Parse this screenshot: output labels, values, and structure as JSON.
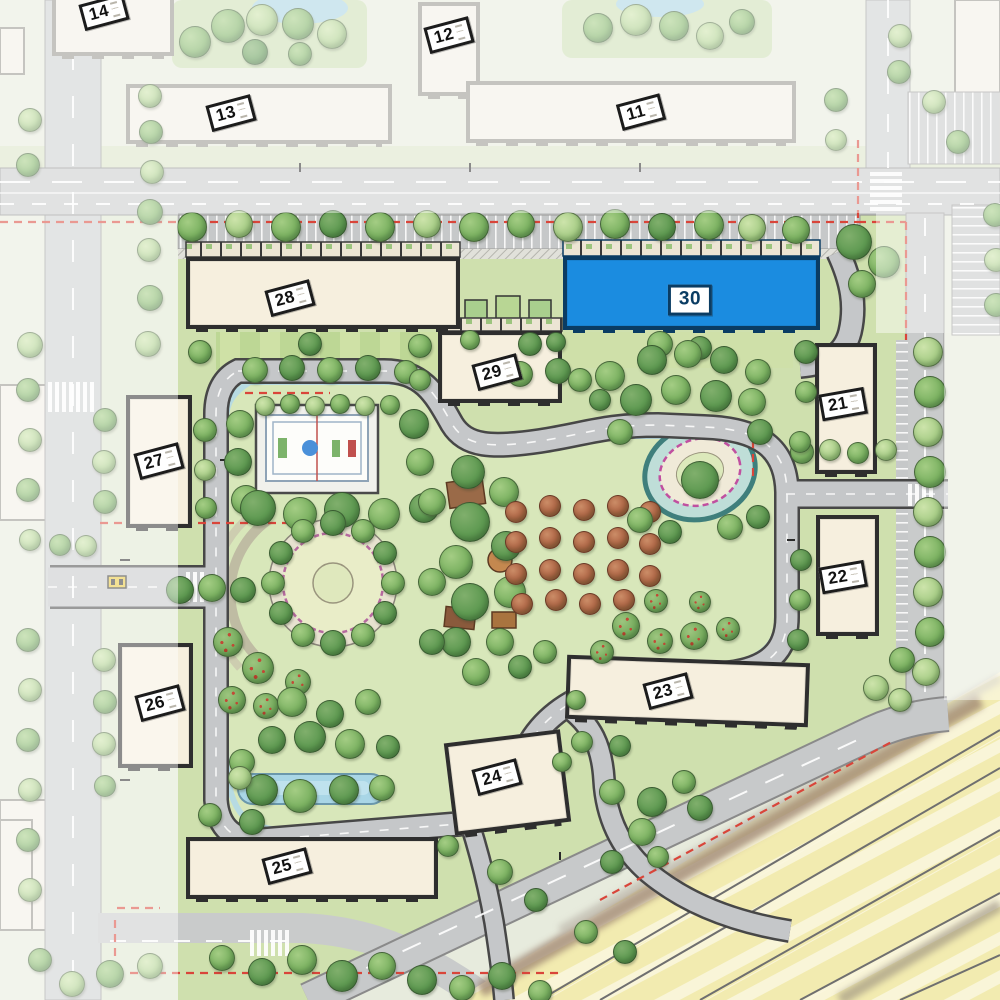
{
  "map": {
    "name": "Residential compound master plan — building selector",
    "colors": {
      "highlight": "#1b8ce0",
      "highlight_border": "#0a3c63",
      "boundary_dash": "#d9453a",
      "building_fill": "#f6efde",
      "park_green": "#d8e7ba",
      "road_gray": "#c7c9ca",
      "railway_yellow": "#f2ebb0"
    },
    "selected_building": "30",
    "buildings": [
      {
        "num": "14",
        "x": 52,
        "y": -6,
        "w": 122,
        "h": 62,
        "rot": 0,
        "lx": 104,
        "ly": 12,
        "lrot": -15,
        "state": "faded"
      },
      {
        "num": "13",
        "x": 126,
        "y": 84,
        "w": 266,
        "h": 60,
        "rot": 0,
        "lx": 231,
        "ly": 113,
        "lrot": -15,
        "state": "faded"
      },
      {
        "num": "12",
        "x": 418,
        "y": 2,
        "w": 62,
        "h": 94,
        "rot": 0,
        "lx": 449,
        "ly": 35,
        "lrot": -15,
        "state": "faded"
      },
      {
        "num": "11",
        "x": 466,
        "y": 81,
        "w": 330,
        "h": 62,
        "rot": 0,
        "lx": 641,
        "ly": 112,
        "lrot": -15,
        "state": "faded"
      },
      {
        "num": "28",
        "x": 186,
        "y": 257,
        "w": 274,
        "h": 72,
        "rot": 0,
        "lx": 290,
        "ly": 298,
        "lrot": -15,
        "state": "normal"
      },
      {
        "num": "30",
        "x": 563,
        "y": 256,
        "w": 257,
        "h": 74,
        "rot": 0,
        "lx": 690,
        "ly": 300,
        "lrot": 0,
        "state": "highlight"
      },
      {
        "num": "29",
        "x": 438,
        "y": 331,
        "w": 124,
        "h": 72,
        "rot": 0,
        "lx": 497,
        "ly": 372,
        "lrot": -15,
        "state": "normal"
      },
      {
        "num": "21",
        "x": 815,
        "y": 343,
        "w": 62,
        "h": 131,
        "rot": 0,
        "lx": 843,
        "ly": 404,
        "lrot": -10,
        "state": "normal"
      },
      {
        "num": "27",
        "x": 126,
        "y": 395,
        "w": 66,
        "h": 133,
        "rot": 0,
        "lx": 159,
        "ly": 461,
        "lrot": -15,
        "state": "normal"
      },
      {
        "num": "22",
        "x": 816,
        "y": 515,
        "w": 63,
        "h": 121,
        "rot": 0,
        "lx": 843,
        "ly": 577,
        "lrot": -10,
        "state": "normal"
      },
      {
        "num": "26",
        "x": 118,
        "y": 643,
        "w": 75,
        "h": 125,
        "rot": 0,
        "lx": 160,
        "ly": 703,
        "lrot": -15,
        "state": "normal"
      },
      {
        "num": "23",
        "x": 566,
        "y": 659,
        "w": 243,
        "h": 64,
        "rot": 2,
        "lx": 668,
        "ly": 691,
        "lrot": -15,
        "state": "normal"
      },
      {
        "num": "24",
        "x": 449,
        "y": 736,
        "w": 117,
        "h": 93,
        "rot": -7,
        "lx": 497,
        "ly": 777,
        "lrot": -15,
        "state": "normal"
      },
      {
        "num": "25",
        "x": 186,
        "y": 837,
        "w": 252,
        "h": 62,
        "rot": 0,
        "lx": 287,
        "ly": 866,
        "lrot": -15,
        "state": "normal"
      }
    ],
    "trees": [
      [
        195,
        42,
        16,
        "m"
      ],
      [
        228,
        26,
        17,
        "m"
      ],
      [
        262,
        20,
        16,
        "l"
      ],
      [
        298,
        24,
        16,
        "m"
      ],
      [
        332,
        34,
        15,
        "l"
      ],
      [
        255,
        52,
        13,
        "d"
      ],
      [
        300,
        54,
        12,
        "m"
      ],
      [
        598,
        28,
        15,
        "m"
      ],
      [
        636,
        20,
        16,
        "l"
      ],
      [
        674,
        26,
        15,
        "m"
      ],
      [
        710,
        36,
        14,
        "l"
      ],
      [
        742,
        22,
        13,
        "m"
      ],
      [
        150,
        96,
        12,
        "l"
      ],
      [
        151,
        132,
        12,
        "m"
      ],
      [
        152,
        172,
        12,
        "l"
      ],
      [
        150,
        212,
        13,
        "m"
      ],
      [
        149,
        250,
        12,
        "l"
      ],
      [
        150,
        298,
        13,
        "m"
      ],
      [
        148,
        344,
        13,
        "l"
      ],
      [
        30,
        120,
        12,
        "l"
      ],
      [
        28,
        165,
        12,
        "m"
      ],
      [
        30,
        345,
        13,
        "l"
      ],
      [
        28,
        390,
        12,
        "m"
      ],
      [
        30,
        440,
        12,
        "l"
      ],
      [
        28,
        490,
        12,
        "m"
      ],
      [
        30,
        540,
        11,
        "l"
      ],
      [
        60,
        545,
        11,
        "m"
      ],
      [
        86,
        546,
        11,
        "l"
      ],
      [
        28,
        640,
        12,
        "m"
      ],
      [
        30,
        690,
        12,
        "l"
      ],
      [
        28,
        740,
        12,
        "m"
      ],
      [
        30,
        790,
        12,
        "l"
      ],
      [
        28,
        840,
        12,
        "m"
      ],
      [
        30,
        890,
        12,
        "l"
      ],
      [
        105,
        420,
        12,
        "m"
      ],
      [
        104,
        462,
        12,
        "l"
      ],
      [
        105,
        502,
        12,
        "m"
      ],
      [
        104,
        660,
        12,
        "l"
      ],
      [
        105,
        702,
        12,
        "m"
      ],
      [
        104,
        744,
        12,
        "l"
      ],
      [
        105,
        786,
        11,
        "m"
      ],
      [
        40,
        960,
        12,
        "m"
      ],
      [
        72,
        984,
        13,
        "l"
      ],
      [
        110,
        974,
        14,
        "m"
      ],
      [
        150,
        966,
        13,
        "l"
      ],
      [
        900,
        36,
        12,
        "l"
      ],
      [
        899,
        72,
        12,
        "m"
      ],
      [
        934,
        102,
        12,
        "l"
      ],
      [
        958,
        142,
        12,
        "m"
      ],
      [
        836,
        100,
        12,
        "m"
      ],
      [
        836,
        140,
        11,
        "l"
      ],
      [
        995,
        215,
        12,
        "m"
      ],
      [
        996,
        260,
        12,
        "l"
      ],
      [
        996,
        305,
        12,
        "m"
      ],
      [
        192,
        227,
        15,
        "m"
      ],
      [
        239,
        224,
        14,
        "l"
      ],
      [
        286,
        227,
        15,
        "m"
      ],
      [
        333,
        224,
        14,
        "d"
      ],
      [
        380,
        227,
        15,
        "m"
      ],
      [
        427,
        224,
        14,
        "l"
      ],
      [
        474,
        227,
        15,
        "m"
      ],
      [
        521,
        224,
        14,
        "m"
      ],
      [
        568,
        227,
        15,
        "l"
      ],
      [
        615,
        224,
        15,
        "m"
      ],
      [
        662,
        227,
        14,
        "d"
      ],
      [
        709,
        225,
        15,
        "m"
      ],
      [
        752,
        228,
        14,
        "l"
      ],
      [
        796,
        230,
        14,
        "m"
      ],
      [
        854,
        242,
        18,
        "d"
      ],
      [
        884,
        262,
        16,
        "m"
      ],
      [
        862,
        284,
        14,
        "m"
      ],
      [
        928,
        352,
        15,
        "l"
      ],
      [
        930,
        392,
        16,
        "m"
      ],
      [
        928,
        432,
        15,
        "l"
      ],
      [
        930,
        472,
        16,
        "m"
      ],
      [
        928,
        512,
        15,
        "l"
      ],
      [
        930,
        552,
        16,
        "m"
      ],
      [
        928,
        592,
        15,
        "l"
      ],
      [
        930,
        632,
        15,
        "m"
      ],
      [
        926,
        672,
        14,
        "l"
      ],
      [
        902,
        660,
        13,
        "m"
      ],
      [
        876,
        688,
        13,
        "l"
      ],
      [
        900,
        700,
        12,
        "l"
      ],
      [
        802,
        452,
        12,
        "m"
      ],
      [
        830,
        450,
        11,
        "l"
      ],
      [
        858,
        453,
        11,
        "m"
      ],
      [
        886,
        450,
        11,
        "l"
      ],
      [
        806,
        352,
        12,
        "d"
      ],
      [
        806,
        392,
        11,
        "m"
      ],
      [
        200,
        352,
        12,
        "m"
      ],
      [
        310,
        344,
        12,
        "d"
      ],
      [
        420,
        346,
        12,
        "m"
      ],
      [
        530,
        344,
        12,
        "d"
      ],
      [
        660,
        344,
        13,
        "m"
      ],
      [
        700,
        348,
        12,
        "d"
      ],
      [
        205,
        430,
        12,
        "m"
      ],
      [
        205,
        470,
        11,
        "l"
      ],
      [
        206,
        508,
        11,
        "m"
      ],
      [
        180,
        590,
        14,
        "d"
      ],
      [
        212,
        588,
        14,
        "m"
      ],
      [
        243,
        590,
        13,
        "d"
      ],
      [
        255,
        370,
        13,
        "m"
      ],
      [
        292,
        368,
        13,
        "d"
      ],
      [
        330,
        370,
        13,
        "m"
      ],
      [
        368,
        368,
        13,
        "d"
      ],
      [
        406,
        372,
        12,
        "m"
      ],
      [
        520,
        374,
        13,
        "m"
      ],
      [
        558,
        371,
        13,
        "d"
      ],
      [
        610,
        376,
        15,
        "m"
      ],
      [
        652,
        360,
        15,
        "d"
      ],
      [
        688,
        354,
        14,
        "m"
      ],
      [
        724,
        360,
        14,
        "d"
      ],
      [
        758,
        372,
        13,
        "m"
      ],
      [
        265,
        406,
        10,
        "l"
      ],
      [
        290,
        404,
        10,
        "m"
      ],
      [
        315,
        406,
        10,
        "l"
      ],
      [
        340,
        404,
        10,
        "m"
      ],
      [
        365,
        406,
        10,
        "l"
      ],
      [
        390,
        405,
        10,
        "m"
      ],
      [
        240,
        424,
        14,
        "m"
      ],
      [
        238,
        462,
        14,
        "d"
      ],
      [
        246,
        500,
        15,
        "m"
      ],
      [
        414,
        424,
        15,
        "d"
      ],
      [
        420,
        462,
        14,
        "m"
      ],
      [
        258,
        508,
        18,
        "d"
      ],
      [
        300,
        514,
        17,
        "m"
      ],
      [
        342,
        510,
        18,
        "d"
      ],
      [
        384,
        514,
        16,
        "m"
      ],
      [
        424,
        508,
        15,
        "d"
      ],
      [
        333,
        523,
        13,
        "d"
      ],
      [
        363,
        531,
        12,
        "m"
      ],
      [
        385,
        553,
        12,
        "d"
      ],
      [
        393,
        583,
        12,
        "m"
      ],
      [
        385,
        613,
        12,
        "d"
      ],
      [
        363,
        635,
        12,
        "m"
      ],
      [
        333,
        643,
        13,
        "d"
      ],
      [
        303,
        635,
        12,
        "m"
      ],
      [
        281,
        613,
        12,
        "d"
      ],
      [
        273,
        583,
        12,
        "m"
      ],
      [
        281,
        553,
        12,
        "d"
      ],
      [
        303,
        531,
        12,
        "m"
      ],
      [
        228,
        642,
        15,
        "f"
      ],
      [
        258,
        668,
        16,
        "f"
      ],
      [
        232,
        700,
        14,
        "f"
      ],
      [
        266,
        706,
        13,
        "f"
      ],
      [
        298,
        682,
        13,
        "f"
      ],
      [
        292,
        702,
        15,
        "m"
      ],
      [
        330,
        714,
        14,
        "d"
      ],
      [
        368,
        702,
        13,
        "m"
      ],
      [
        310,
        737,
        16,
        "d"
      ],
      [
        350,
        744,
        15,
        "m"
      ],
      [
        272,
        740,
        14,
        "d"
      ],
      [
        242,
        762,
        13,
        "m"
      ],
      [
        388,
        747,
        12,
        "d"
      ],
      [
        262,
        790,
        16,
        "d"
      ],
      [
        300,
        796,
        17,
        "m"
      ],
      [
        344,
        790,
        15,
        "d"
      ],
      [
        382,
        788,
        13,
        "m"
      ],
      [
        240,
        778,
        12,
        "l"
      ],
      [
        210,
        815,
        12,
        "m"
      ],
      [
        252,
        822,
        13,
        "d"
      ],
      [
        468,
        472,
        17,
        "d"
      ],
      [
        504,
        492,
        15,
        "m"
      ],
      [
        432,
        502,
        14,
        "m"
      ],
      [
        470,
        522,
        20,
        "d"
      ],
      [
        456,
        562,
        17,
        "m"
      ],
      [
        506,
        546,
        15,
        "d"
      ],
      [
        470,
        602,
        19,
        "d"
      ],
      [
        432,
        582,
        14,
        "m"
      ],
      [
        510,
        592,
        16,
        "m"
      ],
      [
        456,
        642,
        15,
        "d"
      ],
      [
        500,
        642,
        14,
        "m"
      ],
      [
        432,
        642,
        13,
        "d"
      ],
      [
        476,
        672,
        14,
        "m"
      ],
      [
        520,
        667,
        12,
        "d"
      ],
      [
        545,
        652,
        12,
        "m"
      ],
      [
        516,
        512,
        11,
        "o"
      ],
      [
        550,
        506,
        11,
        "o"
      ],
      [
        584,
        510,
        11,
        "o"
      ],
      [
        618,
        506,
        11,
        "o"
      ],
      [
        650,
        512,
        11,
        "o"
      ],
      [
        516,
        542,
        11,
        "o"
      ],
      [
        550,
        538,
        11,
        "o"
      ],
      [
        584,
        542,
        11,
        "o"
      ],
      [
        618,
        538,
        11,
        "o"
      ],
      [
        650,
        544,
        11,
        "o"
      ],
      [
        516,
        574,
        11,
        "o"
      ],
      [
        550,
        570,
        11,
        "o"
      ],
      [
        584,
        574,
        11,
        "o"
      ],
      [
        618,
        570,
        11,
        "o"
      ],
      [
        650,
        576,
        11,
        "o"
      ],
      [
        522,
        604,
        11,
        "o"
      ],
      [
        556,
        600,
        11,
        "o"
      ],
      [
        590,
        604,
        11,
        "o"
      ],
      [
        624,
        600,
        11,
        "o"
      ],
      [
        636,
        400,
        16,
        "d"
      ],
      [
        676,
        390,
        15,
        "m"
      ],
      [
        716,
        396,
        16,
        "d"
      ],
      [
        752,
        402,
        14,
        "m"
      ],
      [
        620,
        432,
        13,
        "m"
      ],
      [
        760,
        432,
        13,
        "d"
      ],
      [
        700,
        480,
        19,
        "d"
      ],
      [
        640,
        520,
        13,
        "m"
      ],
      [
        670,
        532,
        12,
        "d"
      ],
      [
        730,
        527,
        13,
        "m"
      ],
      [
        758,
        517,
        12,
        "d"
      ],
      [
        626,
        626,
        14,
        "f"
      ],
      [
        660,
        641,
        13,
        "f"
      ],
      [
        694,
        636,
        14,
        "f"
      ],
      [
        728,
        629,
        12,
        "f"
      ],
      [
        602,
        652,
        12,
        "f"
      ],
      [
        656,
        601,
        12,
        "f"
      ],
      [
        700,
        602,
        11,
        "f"
      ],
      [
        800,
        442,
        11,
        "m"
      ],
      [
        801,
        560,
        11,
        "d"
      ],
      [
        800,
        600,
        11,
        "m"
      ],
      [
        798,
        640,
        11,
        "d"
      ],
      [
        582,
        742,
        11,
        "m"
      ],
      [
        620,
        746,
        11,
        "d"
      ],
      [
        562,
        762,
        10,
        "m"
      ],
      [
        612,
        792,
        13,
        "m"
      ],
      [
        652,
        802,
        15,
        "d"
      ],
      [
        684,
        782,
        12,
        "m"
      ],
      [
        642,
        832,
        14,
        "m"
      ],
      [
        612,
        862,
        12,
        "d"
      ],
      [
        658,
        857,
        11,
        "m"
      ],
      [
        700,
        808,
        13,
        "d"
      ],
      [
        222,
        958,
        13,
        "m"
      ],
      [
        262,
        972,
        14,
        "d"
      ],
      [
        302,
        960,
        15,
        "m"
      ],
      [
        342,
        976,
        16,
        "d"
      ],
      [
        382,
        966,
        14,
        "m"
      ],
      [
        422,
        980,
        15,
        "d"
      ],
      [
        462,
        988,
        13,
        "m"
      ],
      [
        502,
        976,
        14,
        "d"
      ],
      [
        540,
        992,
        12,
        "m"
      ],
      [
        500,
        872,
        13,
        "m"
      ],
      [
        536,
        900,
        12,
        "d"
      ],
      [
        586,
        932,
        12,
        "m"
      ],
      [
        625,
        952,
        12,
        "d"
      ],
      [
        448,
        846,
        11,
        "m"
      ],
      [
        576,
        700,
        10,
        "m"
      ],
      [
        470,
        340,
        10,
        "m"
      ],
      [
        556,
        342,
        10,
        "d"
      ],
      [
        580,
        380,
        12,
        "m"
      ],
      [
        600,
        400,
        11,
        "d"
      ],
      [
        420,
        380,
        11,
        "m"
      ]
    ]
  }
}
